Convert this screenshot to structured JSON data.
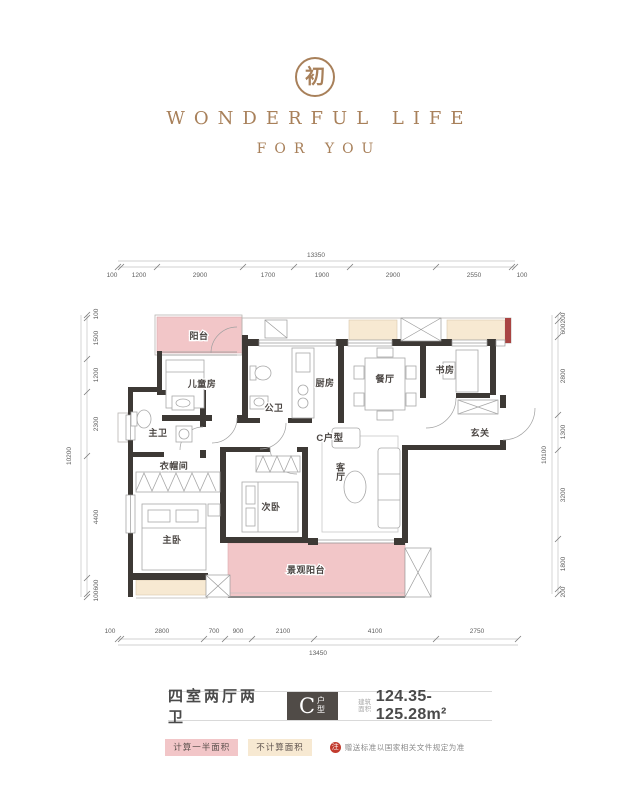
{
  "brand": {
    "seal_char": "初",
    "line1": "WONDERFUL LIFE",
    "line2": "FOR YOU"
  },
  "plan": {
    "unit_label": "C户型",
    "rooms": {
      "balcony": "阳台",
      "kids_room": "儿童房",
      "master_bath": "主卫",
      "cloakroom": "衣帽间",
      "master_bedroom": "主卧",
      "second_bedroom": "次卧",
      "public_bath": "公卫",
      "kitchen": "厨房",
      "dining": "餐厅",
      "study": "书房",
      "foyer": "玄关",
      "living": "客厅",
      "view_balcony": "景观阳台"
    },
    "dims": {
      "top": {
        "total": "13350",
        "segments": [
          "100",
          "1200",
          "2900",
          "1700",
          "1900",
          "2900",
          "2550",
          "100"
        ]
      },
      "bottom": {
        "total": "13450",
        "segments": [
          "100",
          "2800",
          "700",
          "900",
          "2100",
          "4100",
          "2750"
        ]
      },
      "left": {
        "total": "10200",
        "segments": [
          "100",
          "1500",
          "1200",
          "2300",
          "4400",
          "600",
          "100"
        ]
      },
      "right": {
        "total": "10100",
        "segments": [
          "200",
          "600",
          "2800",
          "1300",
          "3200",
          "1800",
          "200"
        ]
      }
    }
  },
  "info": {
    "layout_text": "四室两厅两卫",
    "unit_letter": "C",
    "unit_suffix": "户型",
    "area_label": "建筑面积",
    "area_value": "124.35-125.28m²"
  },
  "legend": {
    "half_area": "计算一半面积",
    "no_area": "不计算面积",
    "note_badge": "注",
    "note_text": "赠送标准以国家相关文件规定为准"
  },
  "colors": {
    "brand": "#a8805a",
    "pink": "#f2c6c8",
    "beige": "#f7e9d2",
    "wall": "#3d3935",
    "red_wall": "#a94442",
    "note_red": "#c23b2e"
  }
}
